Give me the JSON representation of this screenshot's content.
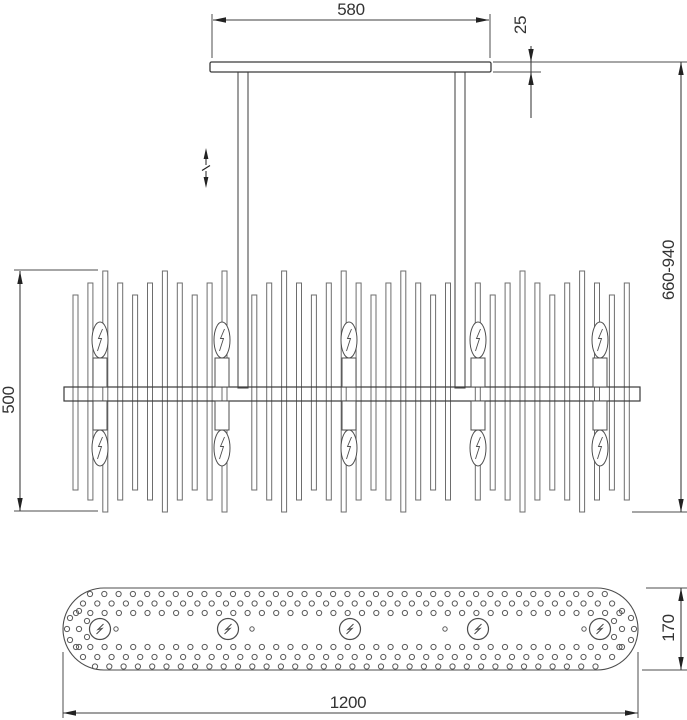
{
  "page": {
    "background": "#ffffff",
    "line_color": "#4d4d4d",
    "accent_line_color": "#3a3a3a",
    "text_color": "#333333"
  },
  "drawing": {
    "kind": "chandelier-dimension-drawing",
    "dims": {
      "canopy_width": "580",
      "canopy_thickness": "25",
      "overall_height": "660-940",
      "body_height": "500",
      "body_length": "1200",
      "body_depth": "170"
    },
    "front_view": {
      "bulb_columns": 5,
      "bulbs_total": 10,
      "decorative_bar_count": 36,
      "suspension_rod_count": 2,
      "height_adjustable_symbol": "double-headed-arrow",
      "bulb_symbol": "candle-bulb-lightning-bolt"
    },
    "plan_view": {
      "socket_count": 5,
      "mount_hole_count": 4,
      "socket_symbol": "circle-lightning-bolt",
      "perforation_rows": 6
    }
  }
}
